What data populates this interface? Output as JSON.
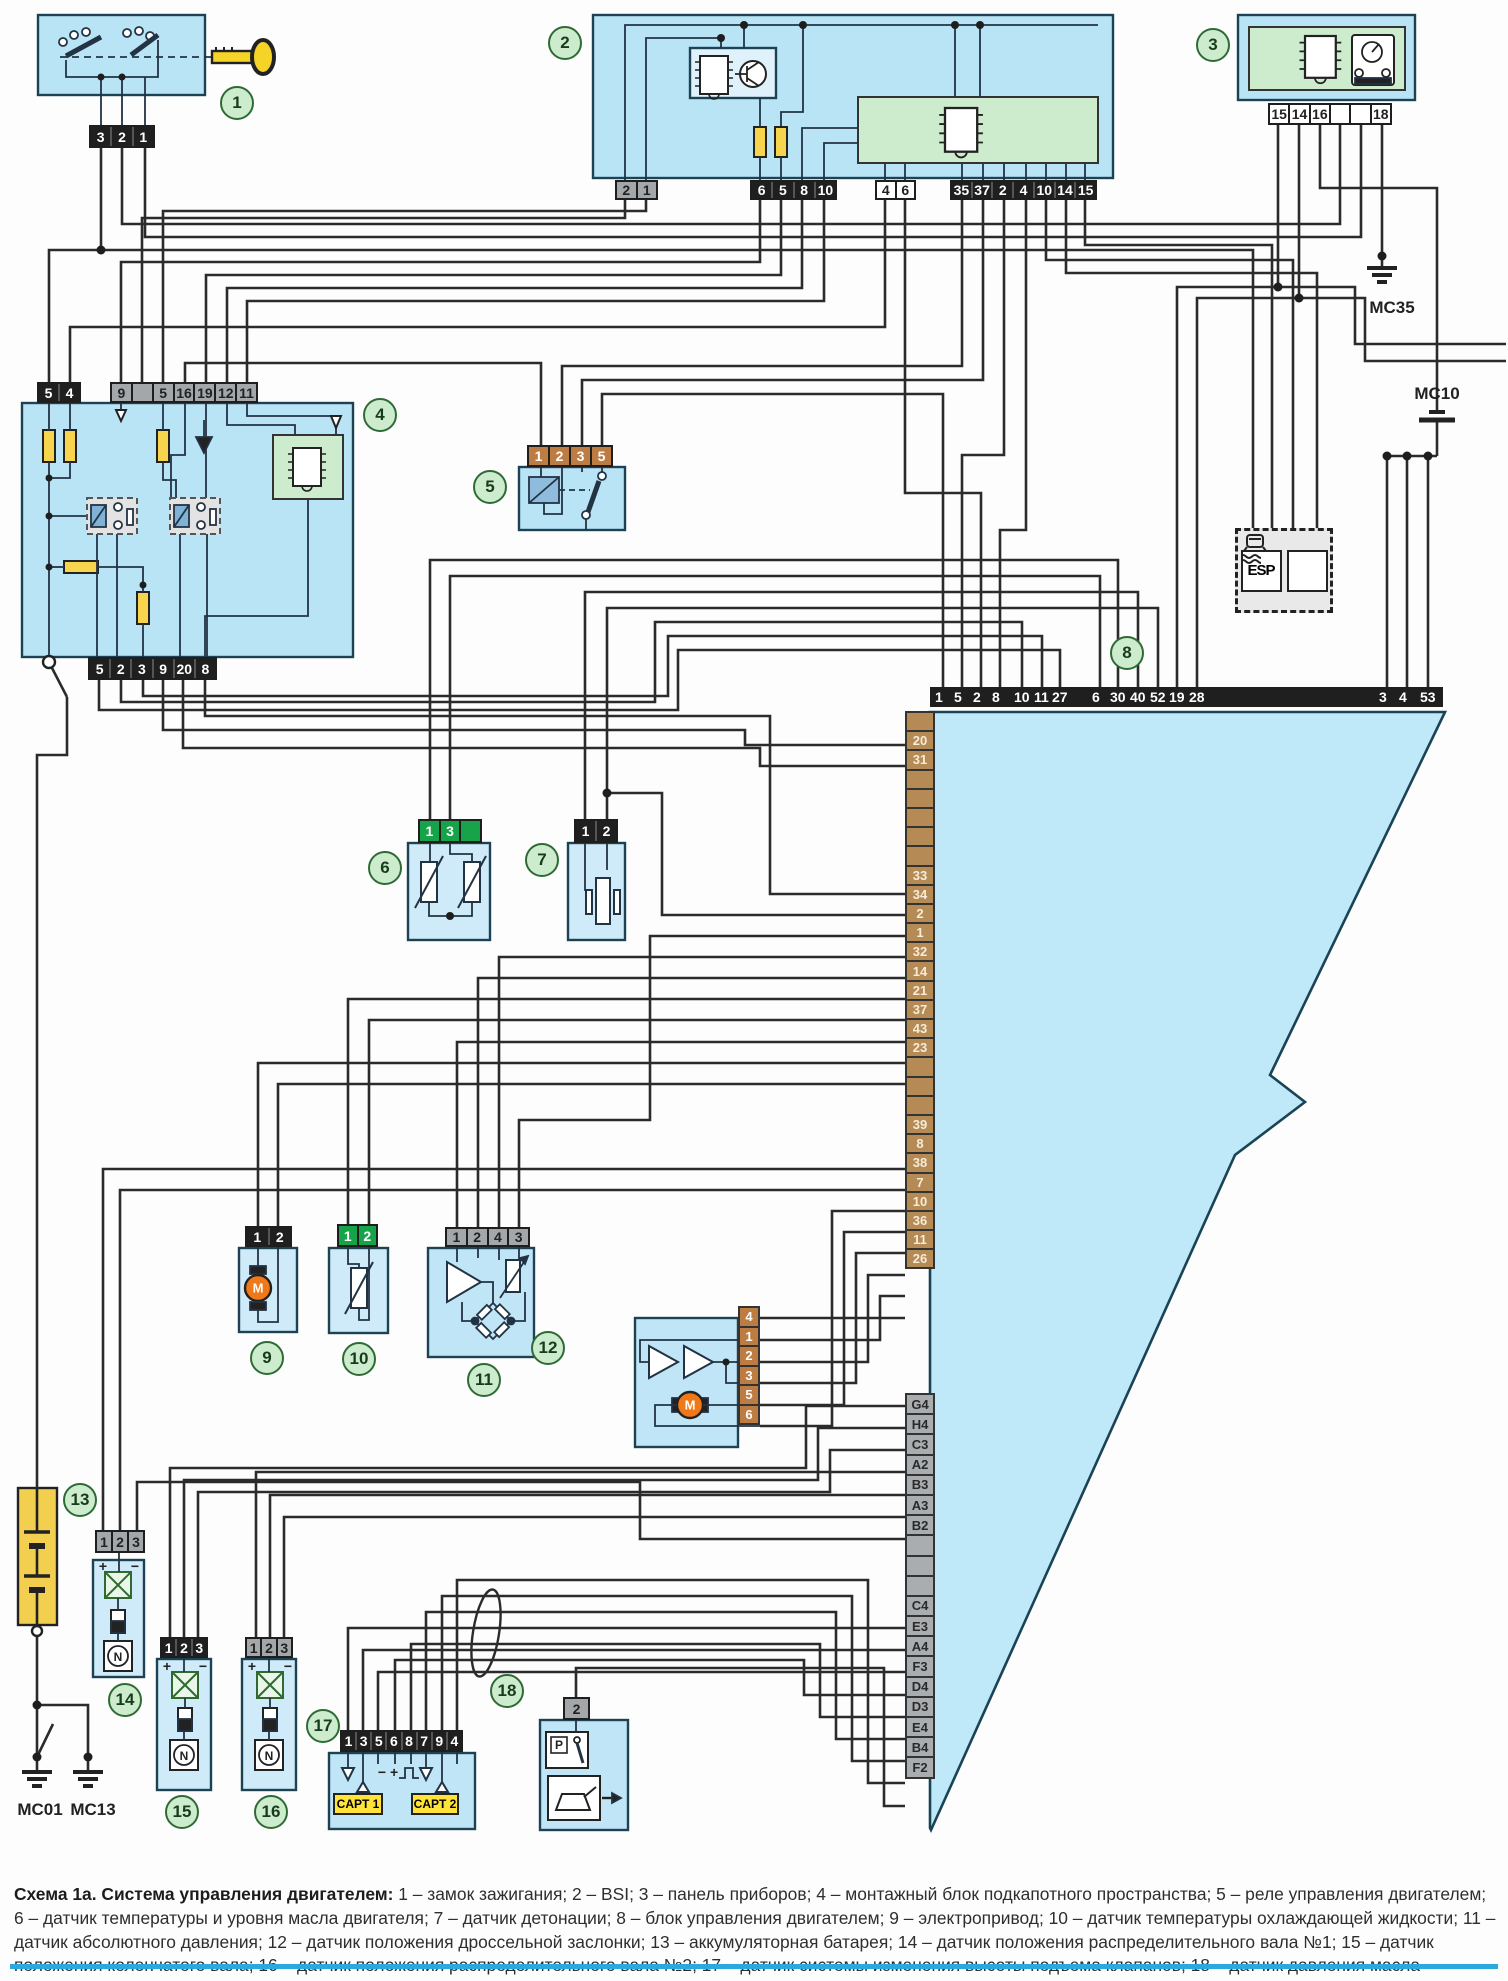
{
  "caption": {
    "bold": "Схема 1а. Система управления двигателем:",
    "text": " 1 – замок зажигания; 2 – BSI; 3 – панель приборов; 4 – монтажный блок подкапотного пространства; 5 – реле управления двигателем; 6 – датчик температуры и уровня масла двигателя; 7 – датчик детонации; 8 – блок управления двигателем; 9 – электропривод; 10 – датчик температуры охлаждающей жидкости; 11 – датчик абсолютного давления; 12 – датчик положения дроссельной заслонки; 13 – аккумуляторная батарея; 14 – датчик положения распределительного вала №1; 15 – датчик положения коленчатого вала; 16 – датчик положения распределительного вала №2; 17 – датчик системы изменения высоты подъема клапанов; 18 – датчик давления масла"
  },
  "grounds": {
    "mc35": "МС35",
    "mc10": "МС10",
    "mc01": "МС01",
    "mc13": "МС13"
  },
  "labels": {
    "c1": "1",
    "c2": "2",
    "c3": "3",
    "c4": "4",
    "c5": "5",
    "c6": "6",
    "c7": "7",
    "c8": "8",
    "c9": "9",
    "c10": "10",
    "c11": "11",
    "c12": "12",
    "c13": "13",
    "c14": "14",
    "c15": "15",
    "c16": "16",
    "c17": "17",
    "c18": "18"
  },
  "esp": {
    "label": "ESP"
  },
  "capt": {
    "one": "CAPT 1",
    "two": "CAPT 2"
  },
  "symbols": {
    "motor": "M",
    "n": "N",
    "p": "P",
    "plus": "+",
    "minus": "−",
    "minus_plus": "−  +"
  },
  "connectors": {
    "ignition": [
      "3",
      "2",
      "1"
    ],
    "bsi_gray": [
      "2",
      "1"
    ],
    "bsi_black": [
      "6",
      "5",
      "8",
      "10"
    ],
    "bsi_white": [
      "4",
      "6"
    ],
    "bsi_black2": [
      "35",
      "37",
      "2",
      "4",
      "10",
      "14",
      "15"
    ],
    "panel": [
      "15",
      "14",
      "16",
      "",
      "",
      "18"
    ],
    "block4_black_top": [
      "5",
      "4"
    ],
    "block4_gray_top": [
      "9",
      "",
      "5",
      "16",
      "19",
      "12",
      "11"
    ],
    "block4_bottom": [
      "5",
      "2",
      "3",
      "9",
      "20",
      "8"
    ],
    "relay5": [
      "1",
      "2",
      "3",
      "5"
    ],
    "sensor6": [
      "1",
      "3",
      ""
    ],
    "sensor7": [
      "1",
      "2"
    ],
    "actuator9": [
      "1",
      "2"
    ],
    "sensor10": [
      "1",
      "2"
    ],
    "sensor11": [
      "1",
      "2",
      "4",
      "3"
    ],
    "throttle12": [
      "4",
      "1",
      "2",
      "3",
      "5",
      "6"
    ],
    "cam14": [
      "1",
      "2",
      "3"
    ],
    "crank15": [
      "1",
      "2",
      "3"
    ],
    "cam16": [
      "1",
      "2",
      "3"
    ],
    "valvetrain17": [
      "1",
      "3",
      "5",
      "6",
      "8",
      "7",
      "9",
      "4"
    ],
    "oil18": [
      "2"
    ]
  },
  "ecu": {
    "top_pins": [
      "1",
      "5",
      "2",
      "8",
      "10",
      "11",
      "27",
      "6",
      "30",
      "40",
      "52",
      "19",
      "28",
      "3",
      "4",
      "53"
    ],
    "left_pins_brown": [
      "",
      "20",
      "31",
      "",
      "",
      "",
      "",
      "",
      "33",
      "34",
      "2",
      "1",
      "32",
      "14",
      "21",
      "37",
      "43",
      "23",
      "",
      "",
      "",
      "39",
      "8",
      "38",
      "7",
      "10",
      "36",
      "11",
      "26"
    ],
    "left_pins_gray": [
      "G4",
      "H4",
      "C3",
      "A2",
      "B3",
      "A3",
      "B2",
      "",
      "",
      "",
      "C4",
      "E3",
      "A4",
      "F3",
      "D4",
      "D3",
      "E4",
      "B4",
      "F2"
    ]
  }
}
